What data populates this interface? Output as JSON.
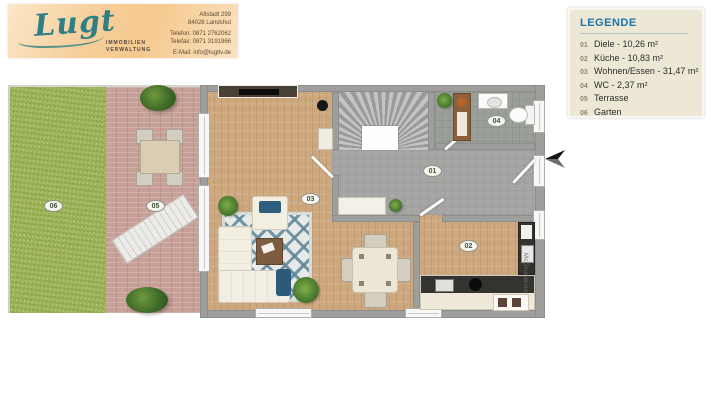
{
  "brand": {
    "name": "Lugt",
    "tagline1": "IMMOBILIEN",
    "tagline2": "VERWALTUNG",
    "contact": {
      "line1": "Altstadt 299",
      "line2": "84028 Landshut",
      "line3": "Telefon: 0871 2762062",
      "line4": "Telefax: 0871 3191966",
      "line5": "E-Mail: info@lugtiv.de"
    }
  },
  "legend": {
    "title": "LEGENDE",
    "items": [
      {
        "num": "01",
        "label": "Diele - 10,26 m²"
      },
      {
        "num": "02",
        "label": "Küche - 10,83 m²"
      },
      {
        "num": "03",
        "label": "Wohnen/Essen - 31,47 m²"
      },
      {
        "num": "04",
        "label": "WC - 2,37 m²"
      },
      {
        "num": "05",
        "label": "Terrasse"
      },
      {
        "num": "06",
        "label": "Garten"
      }
    ]
  },
  "floorplan": {
    "markers": {
      "diele": "01",
      "kueche": "02",
      "wohnen_essen": "03",
      "wc": "04",
      "terrasse": "05",
      "garten": "06"
    },
    "watermark": "McGrundriss"
  },
  "colors": {
    "banner_peach": "#f5c98f",
    "logo_teal": "#2e7f86",
    "legend_bg": "#ece8d5",
    "legend_title_blue": "#1d72a8",
    "grass_green": "#a3b95f",
    "terrace_wood": "#c7a098",
    "interior_wood": "#cda87f",
    "wall_gray": "#9e9e9c",
    "hall_gray": "#a6a6a4",
    "rug_blue": "#5e8598"
  }
}
